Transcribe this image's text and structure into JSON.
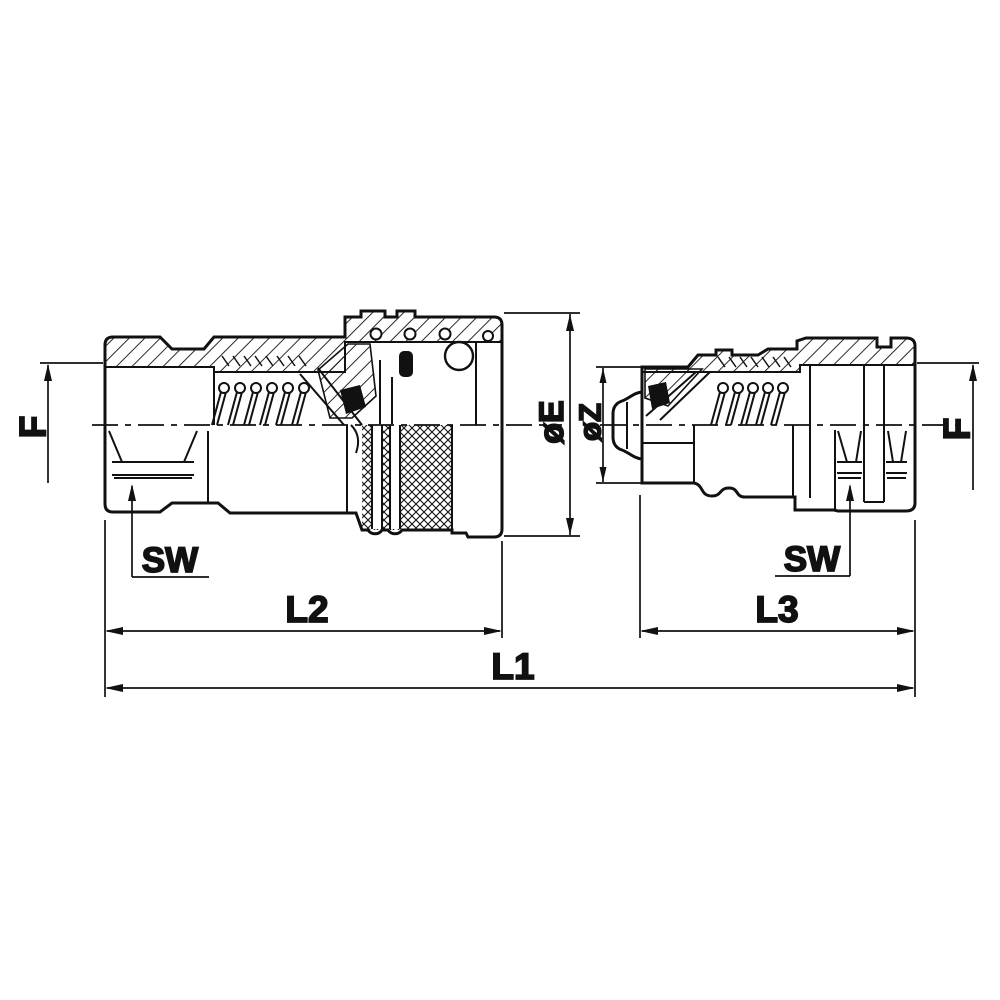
{
  "drawing": {
    "description": "Cross-section technical drawing of a hydraulic quick-release coupling pair: female socket half (left) and male plug half (right)",
    "colors": {
      "line": "#111111",
      "background": "#ffffff"
    }
  },
  "labels": {
    "f_left": "F",
    "f_right": "F",
    "sw_left": "SW",
    "sw_right": "SW",
    "dia_e": "øE",
    "dia_z": "øZ",
    "l1": "L1",
    "l2": "L2",
    "l3": "L3"
  }
}
